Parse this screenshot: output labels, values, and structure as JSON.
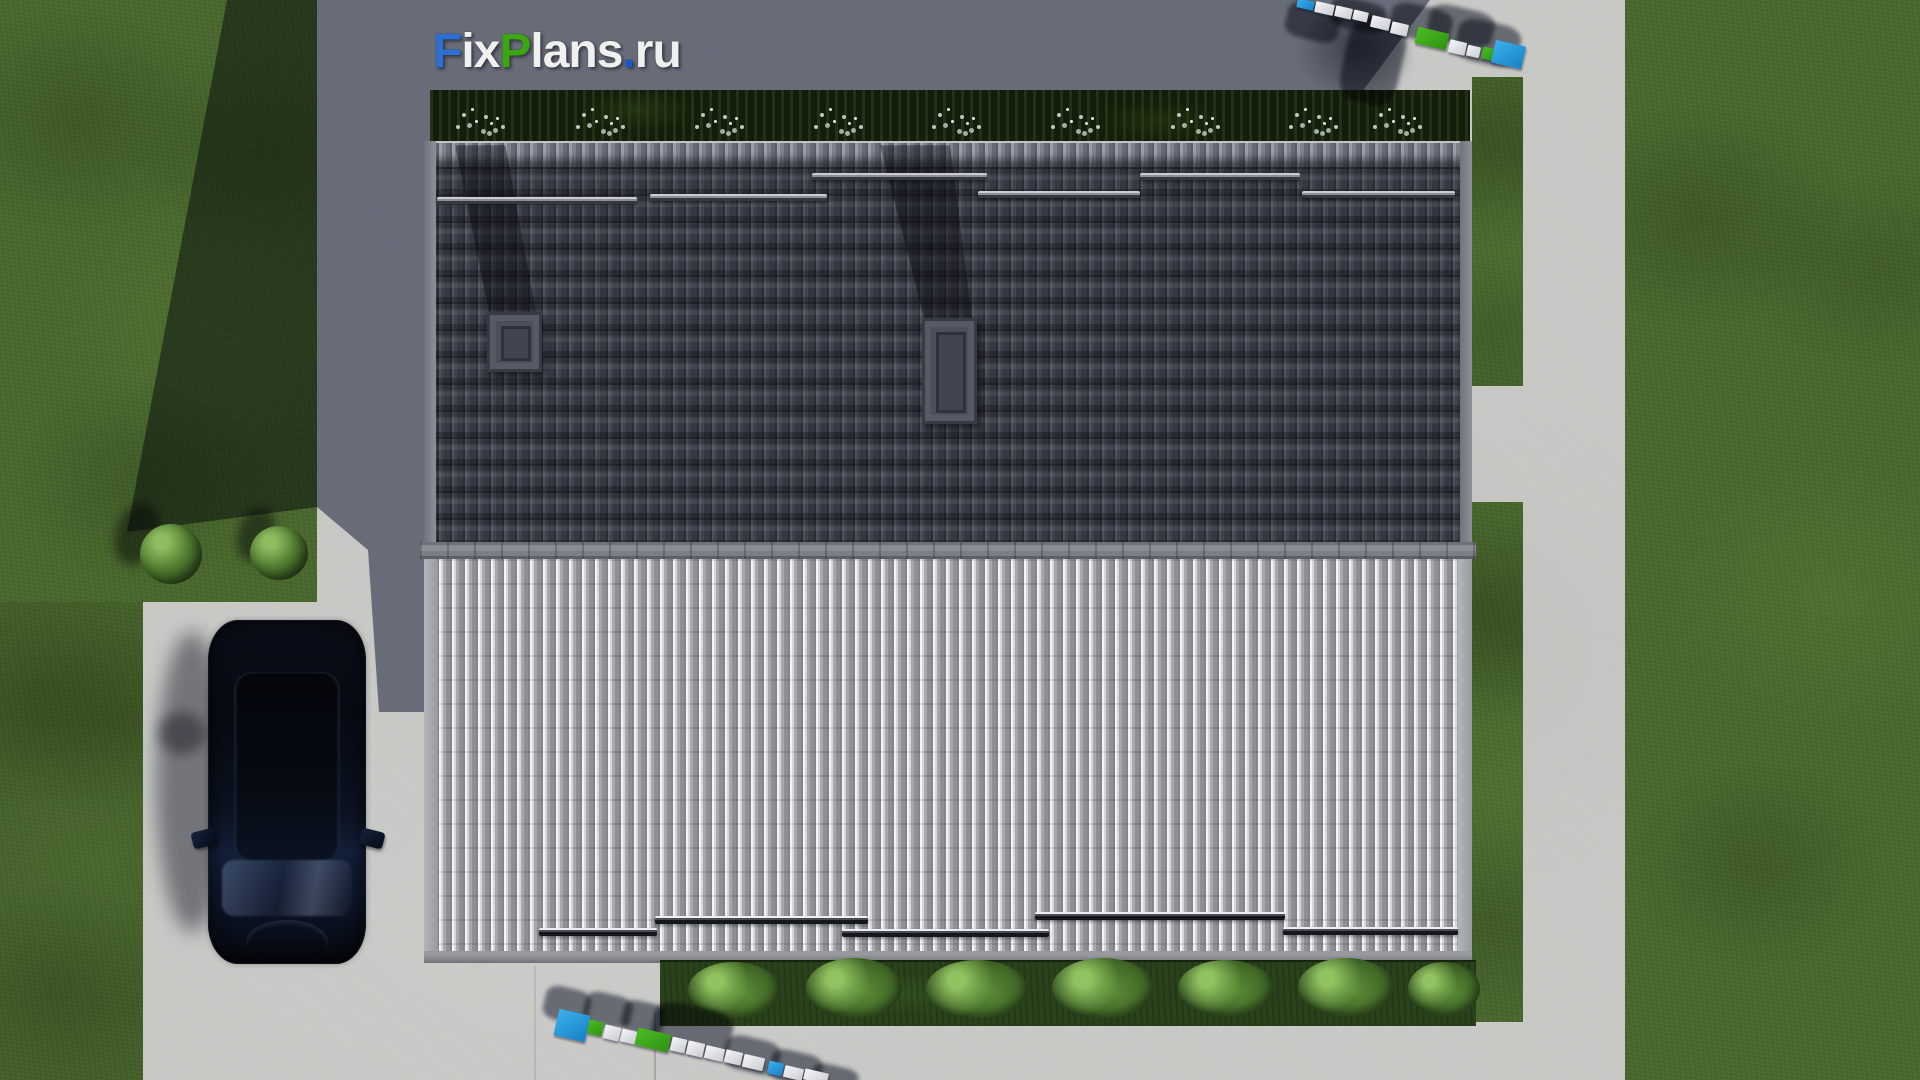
{
  "branding": {
    "site_logo": {
      "full_text": "FixPlans.ru",
      "segments": [
        {
          "text": "F",
          "color": "#2e6fd4"
        },
        {
          "text": "ix",
          "color": "#f0f1ef"
        },
        {
          "text": "P",
          "color": "#3ba60f"
        },
        {
          "text": "lans",
          "color": "#f0f1ef"
        },
        {
          "text": ".",
          "color": "#1d55cd"
        },
        {
          "text": "ru",
          "color": "#f0f1ef"
        }
      ]
    },
    "watermark_3d": {
      "text": "FixPlans.ru",
      "instances": [
        "top-right",
        "bottom-center"
      ],
      "colors": {
        "white": "#eff1f3",
        "blue": "#29a0e2",
        "green": "#3fb31e"
      }
    }
  },
  "scene": {
    "view": "aerial top-down 3D render of a house roof plan",
    "elements": {
      "roof_north_slope": "dark gray barrel-tile roof in shade with 2 chimneys and snow guards",
      "roof_south_slope": "light gray sunlit barrel-tile roof with snow guards",
      "hedge_north": "dark hedge with 9 white flower clusters",
      "shrub_row_south": "7 green bushes along the eave",
      "car": "dark navy SUV parked on driveway, top view",
      "lawn": "green lawns left and right",
      "pavement": "light concrete paths and shaded plaza",
      "left_shrubs": 2,
      "chimneys": 2
    },
    "colors": {
      "roof_dark": "#424651",
      "roof_light": "#b9babd",
      "ridge": "#7e8189",
      "pavement_light": "#c9c9c6",
      "pavement_shaded": "#6e7486",
      "grass": "#4a682d",
      "hedge": "#141d0b",
      "car_body": "#0a0f1c",
      "shadow_tint": "#343c5c"
    }
  }
}
